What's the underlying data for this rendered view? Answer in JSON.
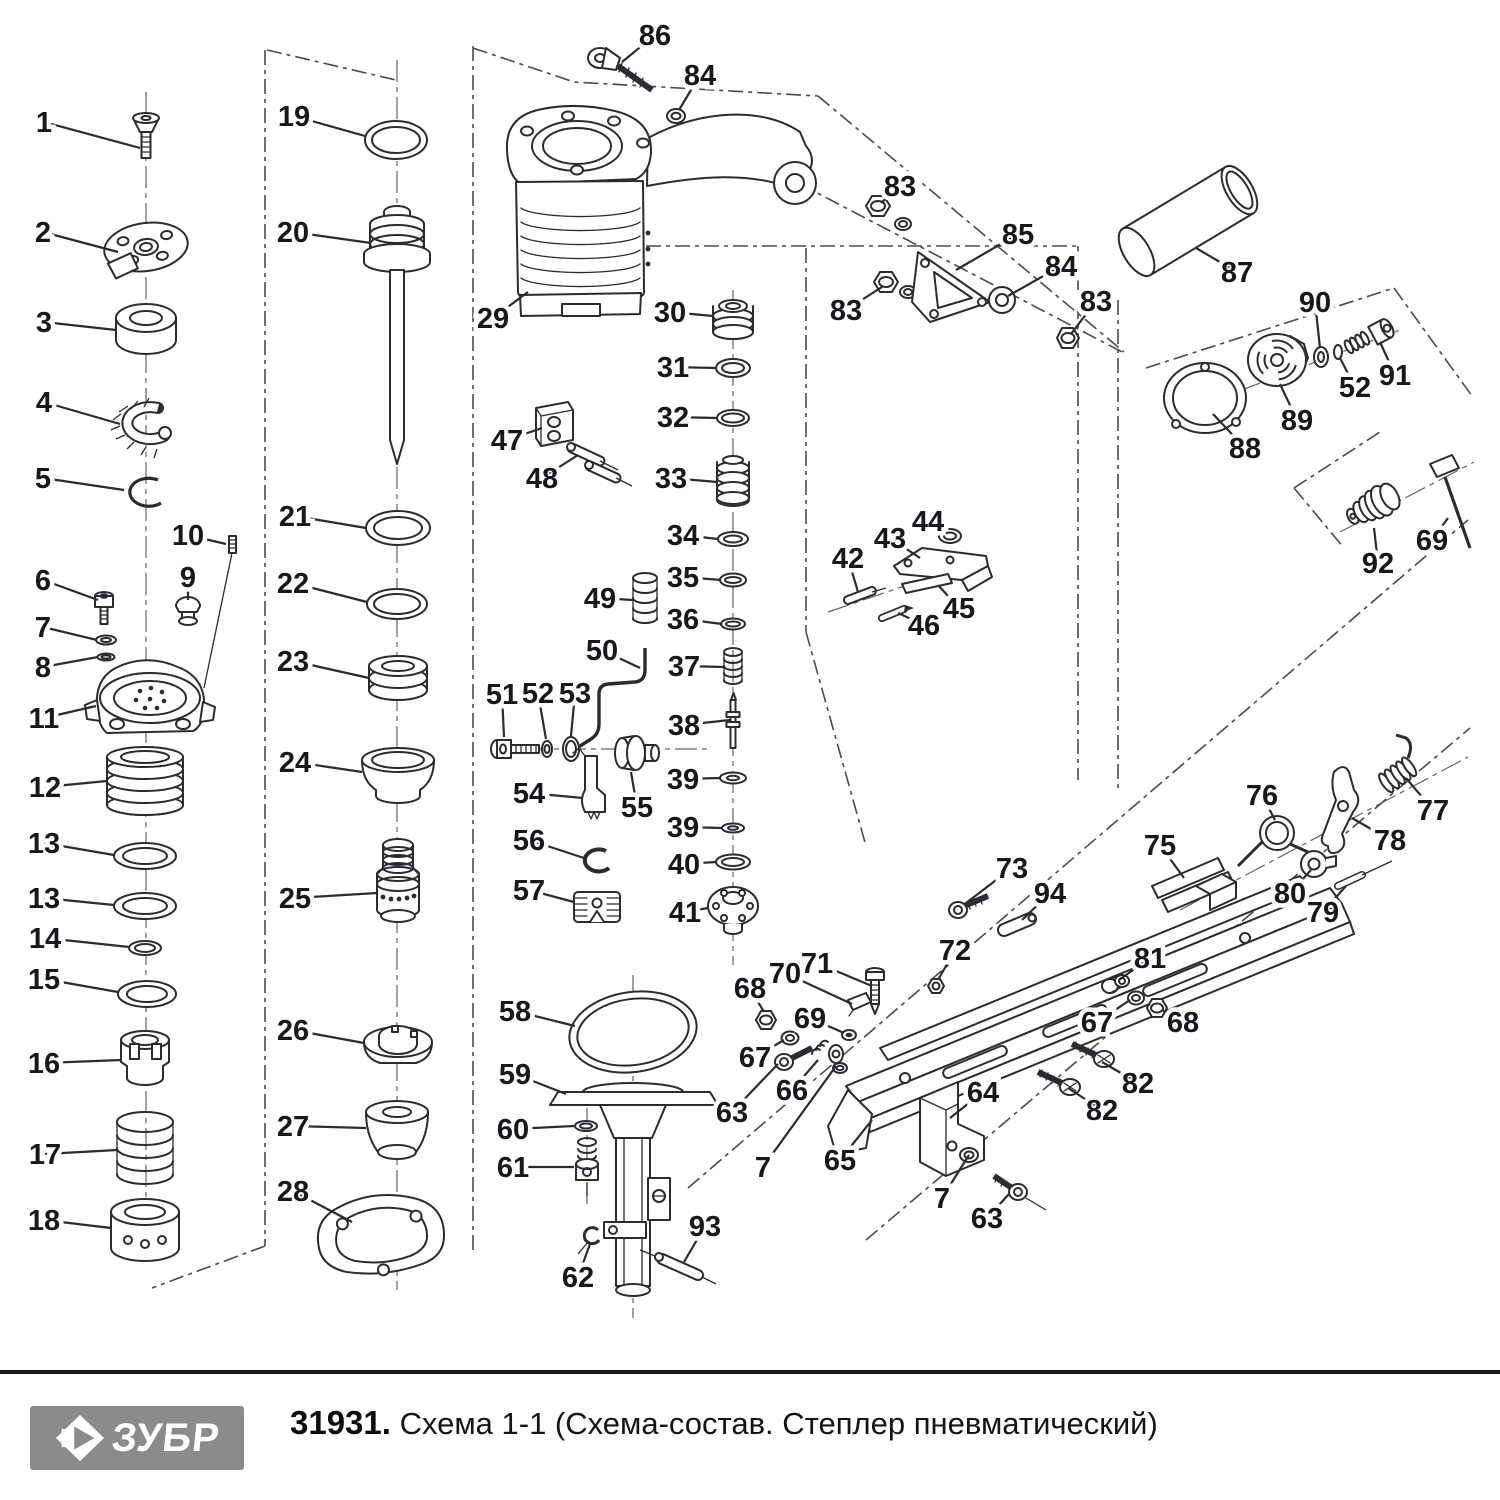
{
  "footer": {
    "logo_text": "ЗУБР",
    "code": "31931.",
    "title": "Схема 1-1 (Схема-состав. Степлер пневматический)"
  },
  "colors": {
    "line": "#2b2b30",
    "label": "#17171c",
    "logo_bg": "#8b8b8b"
  },
  "diagram": {
    "description": "Exploded parts view of pneumatic stapler",
    "callouts": [
      {
        "n": "1",
        "x": 44,
        "y": 122,
        "px": 140,
        "py": 148
      },
      {
        "n": "2",
        "x": 43,
        "y": 232,
        "px": 118,
        "py": 252
      },
      {
        "n": "3",
        "x": 44,
        "y": 322,
        "px": 116,
        "py": 330
      },
      {
        "n": "4",
        "x": 44,
        "y": 402,
        "px": 120,
        "py": 424
      },
      {
        "n": "5",
        "x": 43,
        "y": 478,
        "px": 124,
        "py": 490
      },
      {
        "n": "6",
        "x": 43,
        "y": 580,
        "px": 98,
        "py": 600
      },
      {
        "n": "7",
        "x": 43,
        "y": 627,
        "px": 97,
        "py": 640
      },
      {
        "n": "8",
        "x": 43,
        "y": 667,
        "px": 98,
        "py": 657
      },
      {
        "n": "9",
        "x": 188,
        "y": 577,
        "px": 188,
        "py": 600
      },
      {
        "n": "10",
        "x": 188,
        "y": 535,
        "px": 226,
        "py": 544
      },
      {
        "n": "11",
        "x": 44,
        "y": 718,
        "px": 96,
        "py": 706
      },
      {
        "n": "12",
        "x": 45,
        "y": 787,
        "px": 107,
        "py": 781
      },
      {
        "n": "13",
        "x": 44,
        "y": 843,
        "px": 114,
        "py": 855
      },
      {
        "n": "13",
        "x": 44,
        "y": 898,
        "px": 114,
        "py": 905
      },
      {
        "n": "14",
        "x": 45,
        "y": 938,
        "px": 129,
        "py": 947
      },
      {
        "n": "15",
        "x": 44,
        "y": 979,
        "px": 118,
        "py": 992
      },
      {
        "n": "16",
        "x": 44,
        "y": 1063,
        "px": 121,
        "py": 1060
      },
      {
        "n": "17",
        "x": 45,
        "y": 1154,
        "px": 117,
        "py": 1150
      },
      {
        "n": "18",
        "x": 44,
        "y": 1220,
        "px": 111,
        "py": 1228
      },
      {
        "n": "19",
        "x": 294,
        "y": 116,
        "px": 365,
        "py": 136
      },
      {
        "n": "20",
        "x": 293,
        "y": 232,
        "px": 371,
        "py": 243
      },
      {
        "n": "21",
        "x": 295,
        "y": 516,
        "px": 366,
        "py": 528
      },
      {
        "n": "22",
        "x": 293,
        "y": 583,
        "px": 367,
        "py": 602
      },
      {
        "n": "23",
        "x": 293,
        "y": 661,
        "px": 369,
        "py": 678
      },
      {
        "n": "24",
        "x": 295,
        "y": 762,
        "px": 362,
        "py": 772
      },
      {
        "n": "25",
        "x": 295,
        "y": 898,
        "px": 377,
        "py": 893
      },
      {
        "n": "26",
        "x": 293,
        "y": 1030,
        "px": 364,
        "py": 1043
      },
      {
        "n": "27",
        "x": 293,
        "y": 1126,
        "px": 366,
        "py": 1128
      },
      {
        "n": "28",
        "x": 293,
        "y": 1191,
        "px": 352,
        "py": 1222
      },
      {
        "n": "29",
        "x": 493,
        "y": 318,
        "px": 528,
        "py": 292
      },
      {
        "n": "30",
        "x": 670,
        "y": 312,
        "px": 713,
        "py": 316
      },
      {
        "n": "31",
        "x": 673,
        "y": 367,
        "px": 716,
        "py": 368
      },
      {
        "n": "32",
        "x": 673,
        "y": 417,
        "px": 717,
        "py": 418
      },
      {
        "n": "33",
        "x": 671,
        "y": 478,
        "px": 717,
        "py": 482
      },
      {
        "n": "34",
        "x": 683,
        "y": 535,
        "px": 718,
        "py": 539
      },
      {
        "n": "35",
        "x": 683,
        "y": 577,
        "px": 721,
        "py": 580
      },
      {
        "n": "36",
        "x": 683,
        "y": 619,
        "px": 722,
        "py": 624
      },
      {
        "n": "37",
        "x": 684,
        "y": 666,
        "px": 724,
        "py": 667
      },
      {
        "n": "38",
        "x": 684,
        "y": 725,
        "px": 730,
        "py": 720
      },
      {
        "n": "39",
        "x": 683,
        "y": 779,
        "px": 720,
        "py": 778
      },
      {
        "n": "39",
        "x": 683,
        "y": 827,
        "px": 722,
        "py": 828
      },
      {
        "n": "40",
        "x": 684,
        "y": 864,
        "px": 716,
        "py": 862
      },
      {
        "n": "41",
        "x": 685,
        "y": 912,
        "px": 708,
        "py": 908
      },
      {
        "n": "42",
        "x": 848,
        "y": 558,
        "px": 858,
        "py": 592
      },
      {
        "n": "43",
        "x": 890,
        "y": 538,
        "px": 920,
        "py": 558
      },
      {
        "n": "44",
        "x": 928,
        "y": 521,
        "px": 946,
        "py": 533
      },
      {
        "n": "45",
        "x": 959,
        "y": 608,
        "px": 938,
        "py": 585
      },
      {
        "n": "46",
        "x": 924,
        "y": 625,
        "px": 898,
        "py": 613
      },
      {
        "n": "47",
        "x": 507,
        "y": 440,
        "px": 542,
        "py": 428
      },
      {
        "n": "48",
        "x": 542,
        "y": 478,
        "px": 578,
        "py": 455
      },
      {
        "n": "49",
        "x": 600,
        "y": 598,
        "px": 633,
        "py": 600
      },
      {
        "n": "50",
        "x": 602,
        "y": 650,
        "px": 640,
        "py": 668
      },
      {
        "n": "51",
        "x": 502,
        "y": 694,
        "px": 504,
        "py": 737
      },
      {
        "n": "52",
        "x": 538,
        "y": 693,
        "px": 546,
        "py": 739
      },
      {
        "n": "53",
        "x": 575,
        "y": 693,
        "px": 571,
        "py": 736
      },
      {
        "n": "54",
        "x": 529,
        "y": 793,
        "px": 583,
        "py": 798
      },
      {
        "n": "55",
        "x": 637,
        "y": 807,
        "px": 631,
        "py": 772
      },
      {
        "n": "56",
        "x": 529,
        "y": 840,
        "px": 584,
        "py": 858
      },
      {
        "n": "57",
        "x": 529,
        "y": 890,
        "px": 574,
        "py": 902
      },
      {
        "n": "58",
        "x": 515,
        "y": 1011,
        "px": 575,
        "py": 1026
      },
      {
        "n": "59",
        "x": 515,
        "y": 1074,
        "px": 566,
        "py": 1094
      },
      {
        "n": "60",
        "x": 513,
        "y": 1129,
        "px": 574,
        "py": 1126
      },
      {
        "n": "61",
        "x": 513,
        "y": 1167,
        "px": 574,
        "py": 1167
      },
      {
        "n": "62",
        "x": 578,
        "y": 1277,
        "px": 590,
        "py": 1244
      },
      {
        "n": "63",
        "x": 732,
        "y": 1112,
        "px": 778,
        "py": 1064
      },
      {
        "n": "63",
        "x": 987,
        "y": 1218,
        "px": 1009,
        "py": 1194
      },
      {
        "n": "64",
        "x": 983,
        "y": 1092,
        "px": 950,
        "py": 1118
      },
      {
        "n": "65",
        "x": 840,
        "y": 1160,
        "px": 872,
        "py": 1120
      },
      {
        "n": "66",
        "x": 792,
        "y": 1090,
        "px": 818,
        "py": 1060
      },
      {
        "n": "67",
        "x": 755,
        "y": 1057,
        "px": 784,
        "py": 1040
      },
      {
        "n": "67",
        "x": 1097,
        "y": 1022,
        "px": 1130,
        "py": 1000
      },
      {
        "n": "68",
        "x": 750,
        "y": 988,
        "px": 764,
        "py": 1012
      },
      {
        "n": "68",
        "x": 1183,
        "y": 1022,
        "px": 1162,
        "py": 1010
      },
      {
        "n": "69",
        "x": 810,
        "y": 1018,
        "px": 844,
        "py": 1033
      },
      {
        "n": "69",
        "x": 1432,
        "y": 540,
        "px": 1448,
        "py": 518
      },
      {
        "n": "70",
        "x": 785,
        "y": 973,
        "px": 852,
        "py": 1004
      },
      {
        "n": "71",
        "x": 817,
        "y": 963,
        "px": 872,
        "py": 986
      },
      {
        "n": "72",
        "x": 955,
        "y": 950,
        "px": 938,
        "py": 980
      },
      {
        "n": "73",
        "x": 1012,
        "y": 868,
        "px": 966,
        "py": 903
      },
      {
        "n": "75",
        "x": 1160,
        "y": 845,
        "px": 1184,
        "py": 878
      },
      {
        "n": "76",
        "x": 1262,
        "y": 795,
        "px": 1275,
        "py": 820
      },
      {
        "n": "77",
        "x": 1433,
        "y": 810,
        "px": 1406,
        "py": 778
      },
      {
        "n": "78",
        "x": 1390,
        "y": 840,
        "px": 1352,
        "py": 818
      },
      {
        "n": "79",
        "x": 1323,
        "y": 912,
        "px": 1346,
        "py": 886
      },
      {
        "n": "80",
        "x": 1290,
        "y": 893,
        "px": 1311,
        "py": 870
      },
      {
        "n": "81",
        "x": 1150,
        "y": 958,
        "px": 1119,
        "py": 980
      },
      {
        "n": "82",
        "x": 1138,
        "y": 1083,
        "px": 1102,
        "py": 1062
      },
      {
        "n": "82",
        "x": 1102,
        "y": 1110,
        "px": 1068,
        "py": 1088
      },
      {
        "n": "83",
        "x": 900,
        "y": 186,
        "px": 881,
        "py": 203
      },
      {
        "n": "83",
        "x": 846,
        "y": 310,
        "px": 882,
        "py": 287
      },
      {
        "n": "83",
        "x": 1096,
        "y": 301,
        "px": 1071,
        "py": 334
      },
      {
        "n": "84",
        "x": 700,
        "y": 75,
        "px": 679,
        "py": 110
      },
      {
        "n": "84",
        "x": 1061,
        "y": 266,
        "px": 1008,
        "py": 296
      },
      {
        "n": "85",
        "x": 1018,
        "y": 234,
        "px": 956,
        "py": 270
      },
      {
        "n": "86",
        "x": 655,
        "y": 35,
        "px": 622,
        "py": 62
      },
      {
        "n": "87",
        "x": 1237,
        "y": 272,
        "px": 1196,
        "py": 248
      },
      {
        "n": "88",
        "x": 1245,
        "y": 448,
        "px": 1213,
        "py": 414
      },
      {
        "n": "89",
        "x": 1297,
        "y": 420,
        "px": 1280,
        "py": 384
      },
      {
        "n": "90",
        "x": 1315,
        "y": 302,
        "px": 1320,
        "py": 348
      },
      {
        "n": "91",
        "x": 1395,
        "y": 375,
        "px": 1380,
        "py": 342
      },
      {
        "n": "52",
        "x": 1355,
        "y": 387,
        "px": 1340,
        "py": 358
      },
      {
        "n": "92",
        "x": 1378,
        "y": 563,
        "px": 1374,
        "py": 528
      },
      {
        "n": "93",
        "x": 705,
        "y": 1226,
        "px": 684,
        "py": 1262
      },
      {
        "n": "94",
        "x": 1050,
        "y": 893,
        "px": 1022,
        "py": 920
      },
      {
        "n": "7",
        "x": 763,
        "y": 1167,
        "px": 836,
        "py": 1066
      },
      {
        "n": "7",
        "x": 942,
        "y": 1198,
        "px": 969,
        "py": 1155
      }
    ]
  }
}
